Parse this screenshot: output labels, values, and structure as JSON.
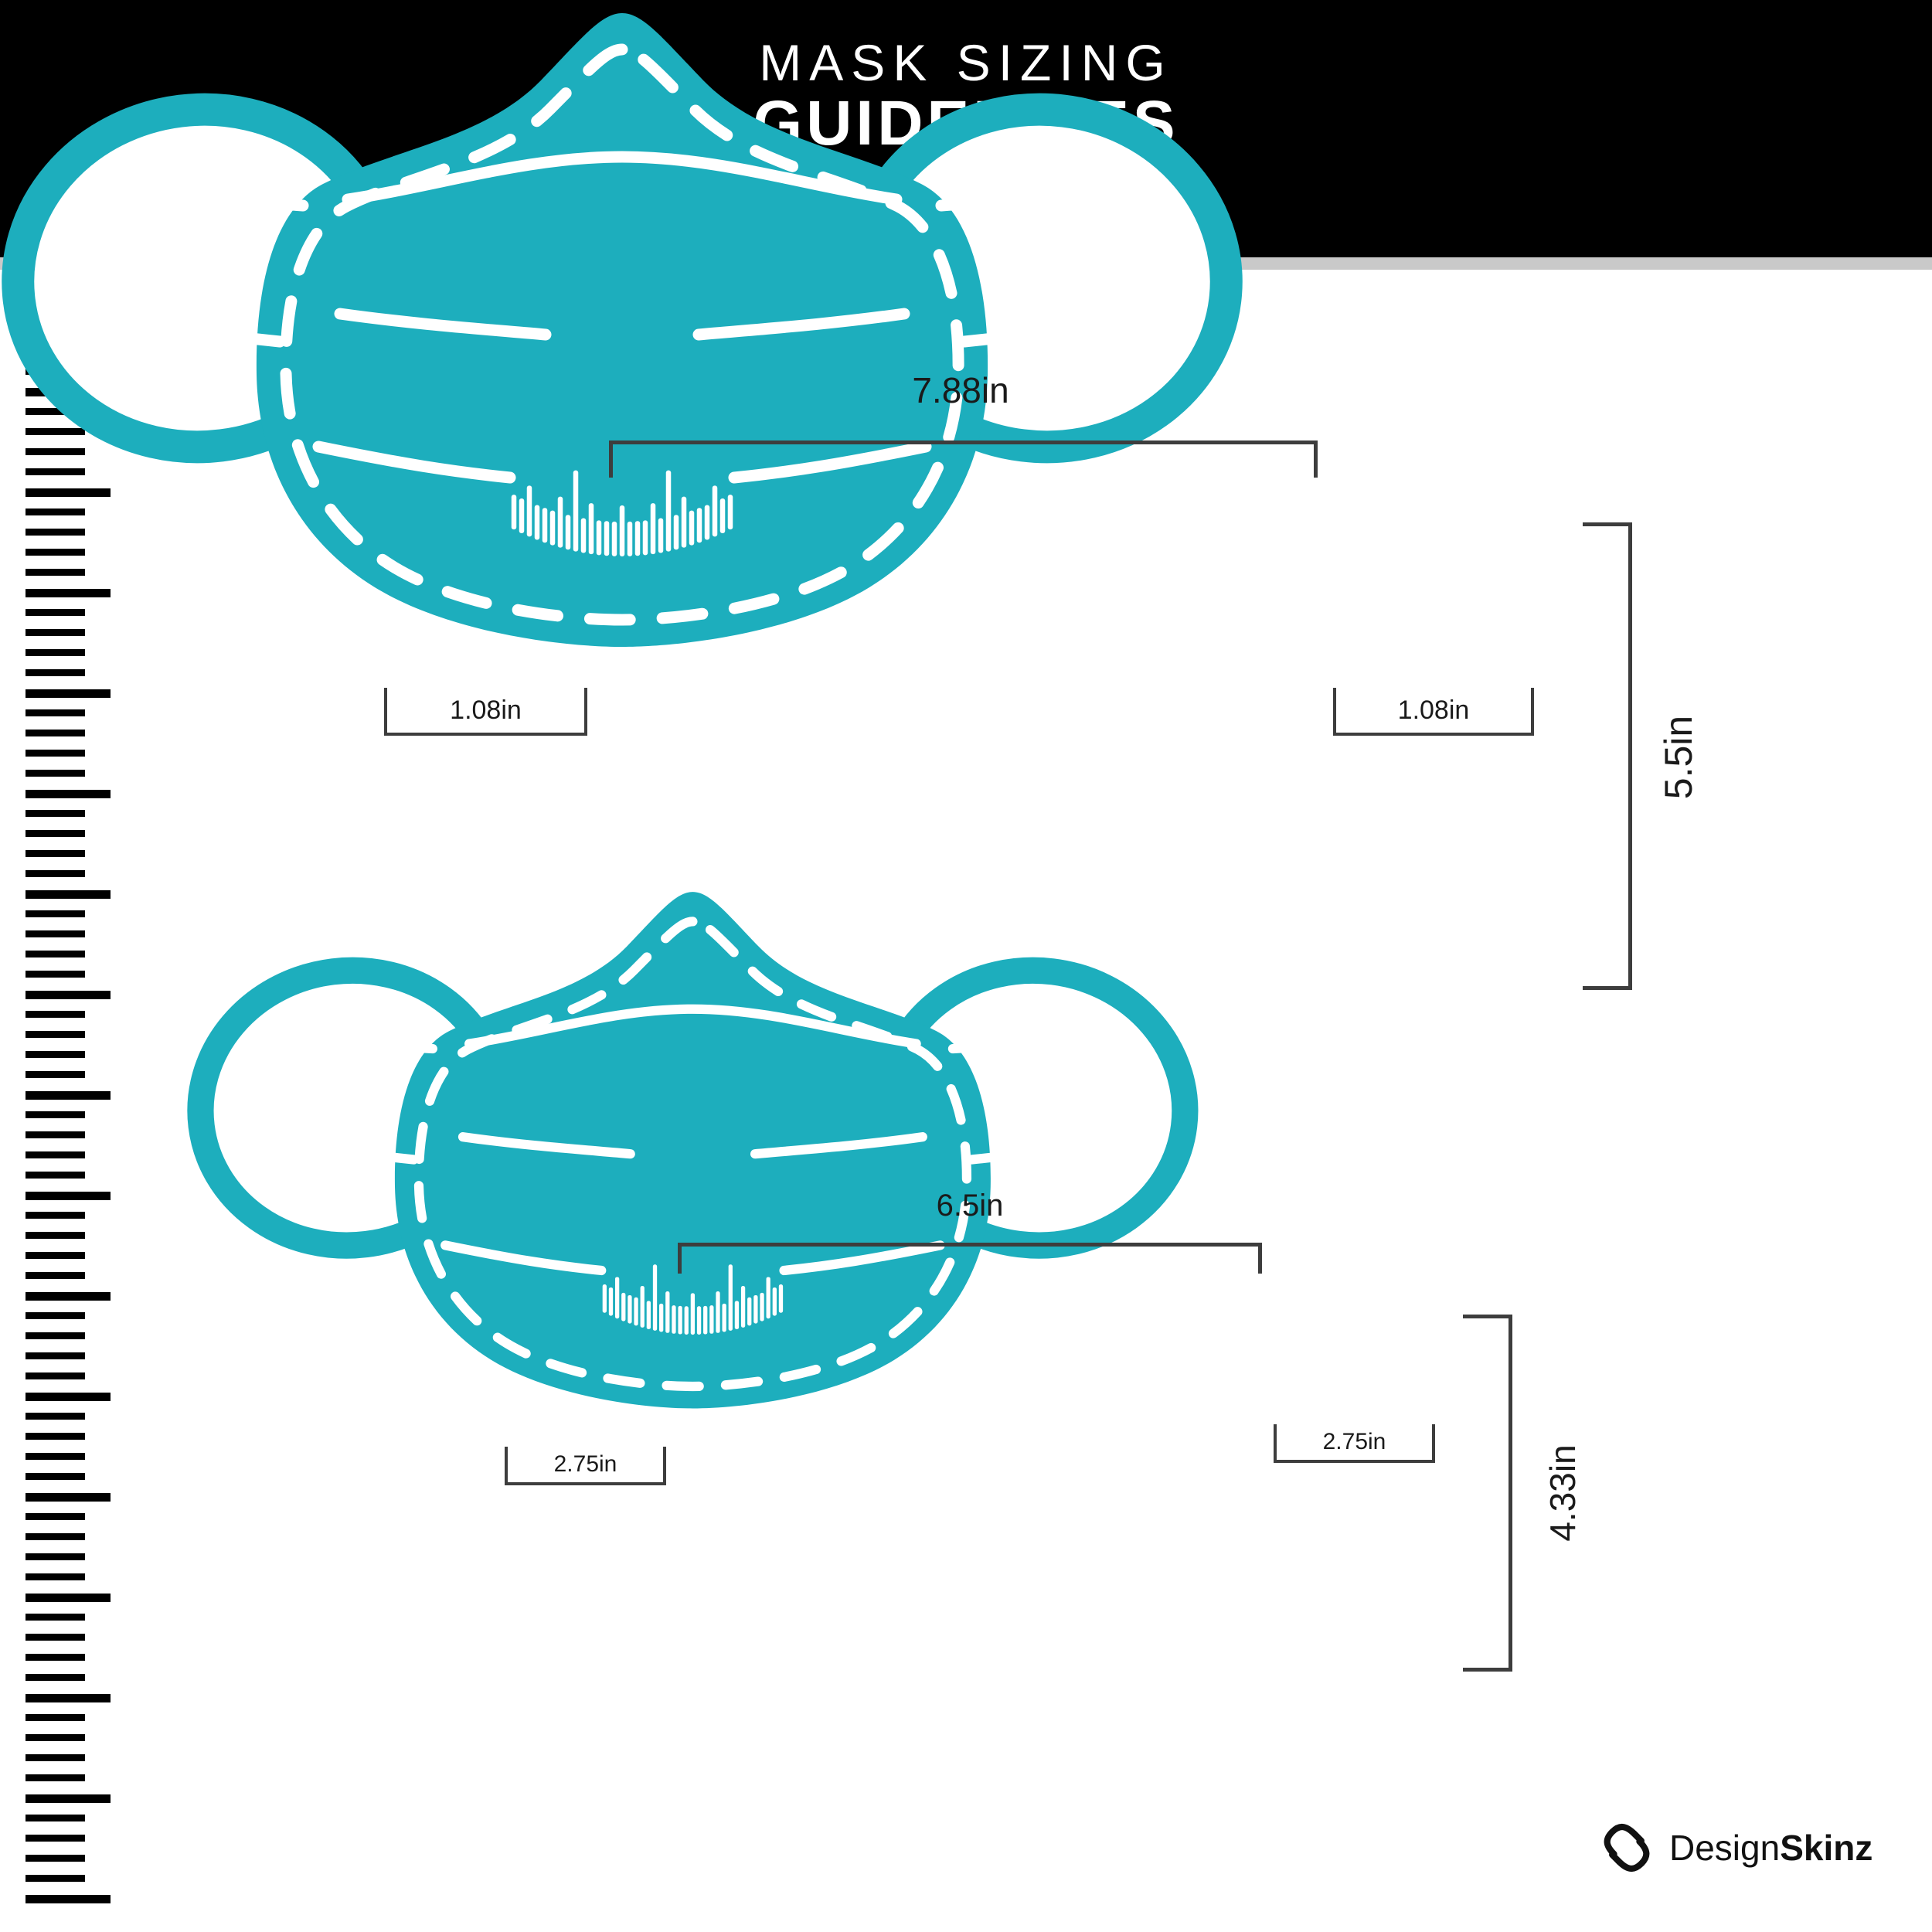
{
  "header": {
    "title_line1": "MASK SIZING",
    "title_line2": "GUIDELINES"
  },
  "masks": [
    {
      "id": "large",
      "letter": "L",
      "name": "LARGE",
      "width_label": "7.88in",
      "height_label": "5.5in",
      "left_ear_label": "1.08in",
      "right_ear_label": "1.08in"
    },
    {
      "id": "small",
      "letter": "S",
      "name": "SMALL",
      "width_label": "6.5in",
      "height_label": "4.33in",
      "left_ear_label": "2.75in",
      "right_ear_label": "2.75in"
    }
  ],
  "branding": {
    "brand_regular": "Design",
    "brand_bold": "Skinz",
    "brand_icon": "designskinz-diamond-s-icon"
  },
  "icons": {
    "left_graphic": "ruler-ticks-icon",
    "mask_motif": "ruler-teeth-motif-icon"
  },
  "colors": {
    "mask_teal": "#1DAEBD",
    "header_bg": "#000000",
    "divider_gray": "#C9C9C9",
    "bracket_gray": "#3D3D3D",
    "text_dark": "#1A1A1A",
    "mask_text_white": "#FFFFFF"
  }
}
